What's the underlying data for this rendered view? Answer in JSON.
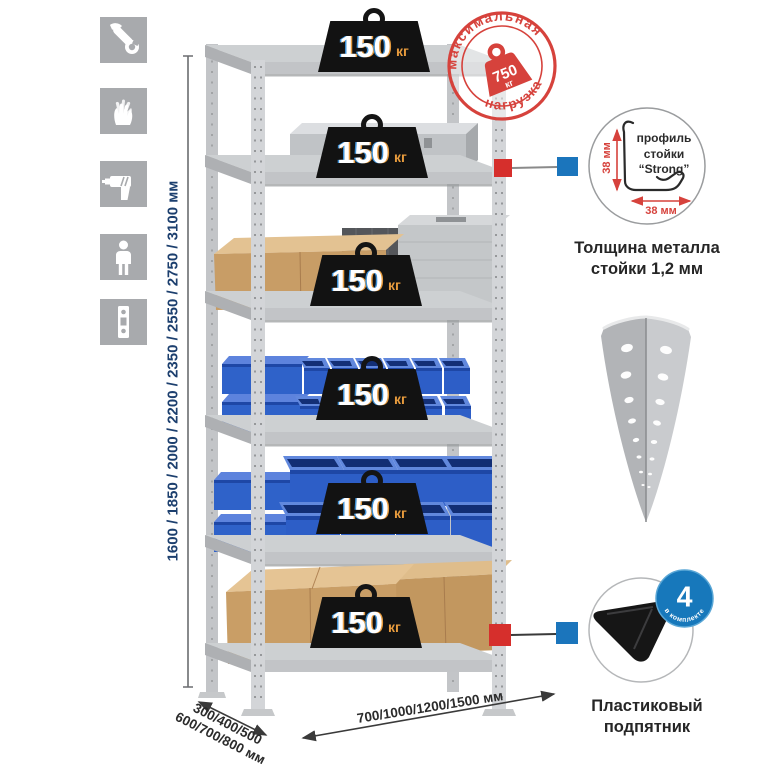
{
  "left_icons": [
    "wrench",
    "gloves",
    "drill",
    "person",
    "shelf-post"
  ],
  "stamp": {
    "arc_top": "максимальная",
    "arc_bottom": "нагрузка",
    "weight_value": "750",
    "weight_unit": "кг"
  },
  "weight": {
    "value": "150",
    "unit": "кг"
  },
  "dimensions": {
    "height": "1600 / 1850 / 2000 / 2200 / 2350 / 2550 / 2750 / 3100 мм",
    "depth_line1": "300/400/500",
    "depth_line2": "600/700/800 мм",
    "width": "700/1000/1200/1500 мм"
  },
  "profile_detail": {
    "label_line1": "профиль",
    "label_line2": "стойки",
    "label_line3": "“Strong”",
    "dim_vertical": "38 мм",
    "dim_horizontal": "38 мм",
    "caption_line1": "Толщина металла",
    "caption_line2": "стойки 1,2 мм"
  },
  "foot_detail": {
    "badge_value": "4",
    "badge_arc": "в комплекте",
    "caption_line1": "Пластиковый",
    "caption_line2": "подпятник"
  },
  "colors": {
    "accent_red": "#d6423c",
    "connector_red": "#d62f2c",
    "connector_blue": "#1b75bc",
    "badge_blue": "#1778bb",
    "bin_blue": "#2d5ec7",
    "dim_navy": "#1c3f6e",
    "weight_unit_orange": "#e79b3d",
    "icon_gray": "#a8aaad"
  }
}
